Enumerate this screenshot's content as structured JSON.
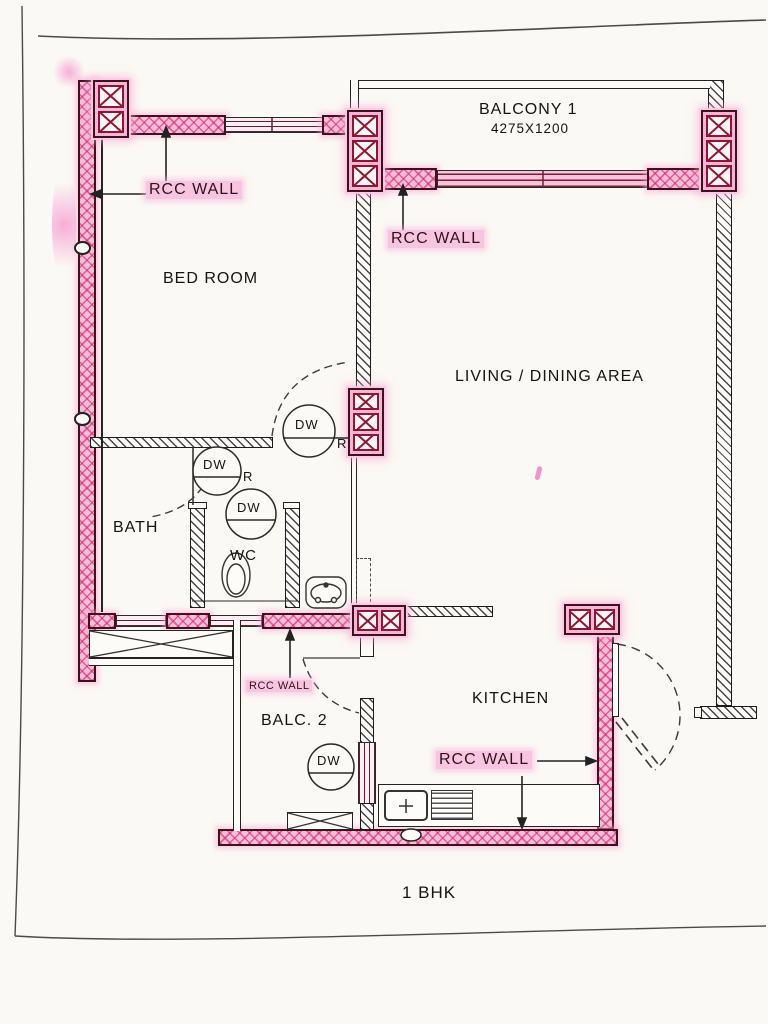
{
  "title": "1 BHK",
  "plan_type": "floor-plan",
  "rooms": {
    "balcony1": {
      "name": "BALCONY 1",
      "dimension": "4275X1200"
    },
    "bedroom": {
      "name": "BED ROOM"
    },
    "living": {
      "name": "LIVING / DINING AREA"
    },
    "bath": {
      "name": "BATH"
    },
    "wc": {
      "name": "WC"
    },
    "balc2": {
      "name": "BALC. 2"
    },
    "kitchen": {
      "name": "KITCHEN"
    }
  },
  "labels": {
    "rcc1": "RCC WALL",
    "rcc2": "RCC WALL",
    "rcc3": "RCC WALL",
    "rcc4": "RCC WALL"
  },
  "markers": {
    "dw": "DW",
    "r": "R"
  },
  "colors": {
    "wall_pink": "#f7bcd9",
    "crosshatch_pink": "#d6336c",
    "wall_outline": "#40101c",
    "xbox_red": "#8a1830",
    "line_black": "#1b1b1b",
    "highlight_pink": "#f8c4e0"
  }
}
